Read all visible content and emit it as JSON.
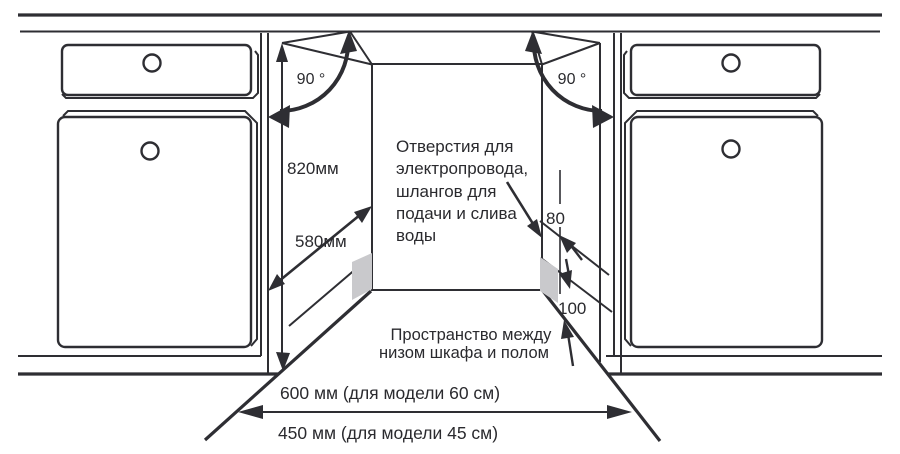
{
  "diagram": {
    "title": "Схема встраивания посудомоечной машины в нишу кухни",
    "left_angle_label": "90 °",
    "right_angle_label": "90 °",
    "niche_height_label": "820мм",
    "niche_depth_label": "580мм",
    "holes_note": {
      "line1": "Отверстия для",
      "line2": "электропровода,",
      "line3": "шлангов для",
      "line4": "подачи и слива",
      "line5": "воды"
    },
    "hole_dim_label": "80",
    "plinth_dim_label": "100",
    "floor_note": {
      "line1": "Пространство между",
      "line2": "низом шкафа и полом"
    },
    "width_model60_label": "600 мм (для модели 60 см)",
    "width_model45_label": "450 мм (для модели 45 см)",
    "colors": {
      "ink": "#2e2e33",
      "text": "#2a2a2e",
      "panel_gray": "#c9c9cc",
      "background": "#ffffff"
    }
  }
}
